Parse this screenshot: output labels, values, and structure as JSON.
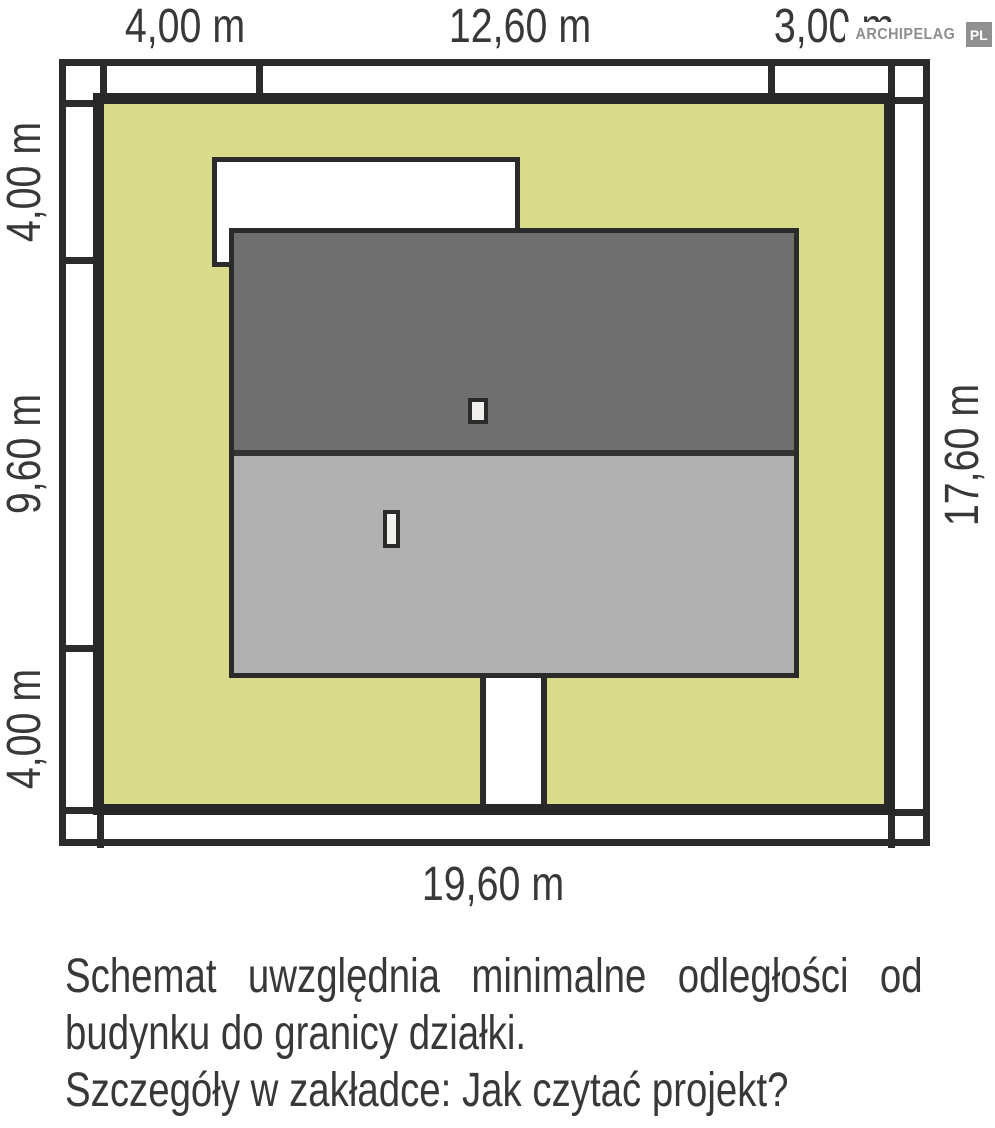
{
  "logo": {
    "name": "ARCHIPELAG",
    "tld": "PL"
  },
  "dimensions": {
    "top": [
      "4,00 m",
      "12,60 m",
      "3,00 m"
    ],
    "left": [
      "4,00 m",
      "9,60 m",
      "4,00 m"
    ],
    "right": "17,60 m",
    "bottom": "19,60 m"
  },
  "caption": {
    "line1": "Schemat uwzględnia minimalne odległości od",
    "line2": "budynku do granicy działki.",
    "line3": "Szczegóły w zakładce: Jak czytać projekt?"
  },
  "colors": {
    "plot-green": "#d7db8a",
    "plot-border": "#282828",
    "line-dark": "#2b2b2b",
    "roof-dark": "#6f6f6f",
    "roof-light": "#b1b1b1",
    "ridge": "#333333",
    "surface-white": "#ffffff",
    "chimney-fill": "#f1f0ec",
    "text-dark": "#383838",
    "logo-gray": "#8d8d8d",
    "logo-box": "#909090"
  }
}
